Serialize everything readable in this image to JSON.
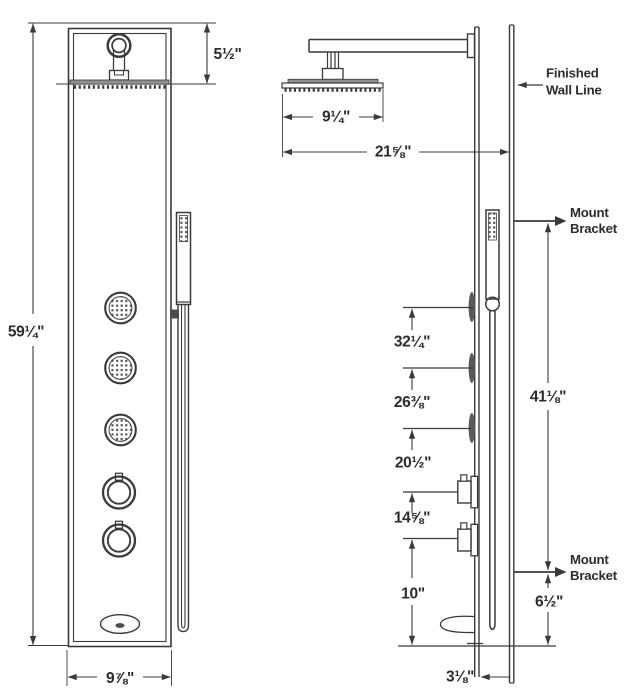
{
  "colors": {
    "line": "#3a393b",
    "metal_gray": "#8e9092",
    "dot_gray": "#4c4b4d",
    "text": "#2c2b2e"
  },
  "front_view": {
    "overall_height": "59¼\"",
    "showerhead_offset": "5½\"",
    "panel_width": "9⅞\""
  },
  "side_view": {
    "showerhead_width": "9¼\"",
    "showerhead_reach": "21⅝\"",
    "wall_label": {
      "line1": "Finished",
      "line2": "Wall Line"
    },
    "bracket_label": {
      "line1": "Mount",
      "line2": "Bracket"
    },
    "upper_bracket_span": "41⅛\"",
    "fixture_heights": [
      "32¼\"",
      "26⅜\"",
      "20½\"",
      "14⅝\"",
      "10\""
    ],
    "lower_bracket_span": "6½\"",
    "panel_depth": "3⅛\""
  }
}
